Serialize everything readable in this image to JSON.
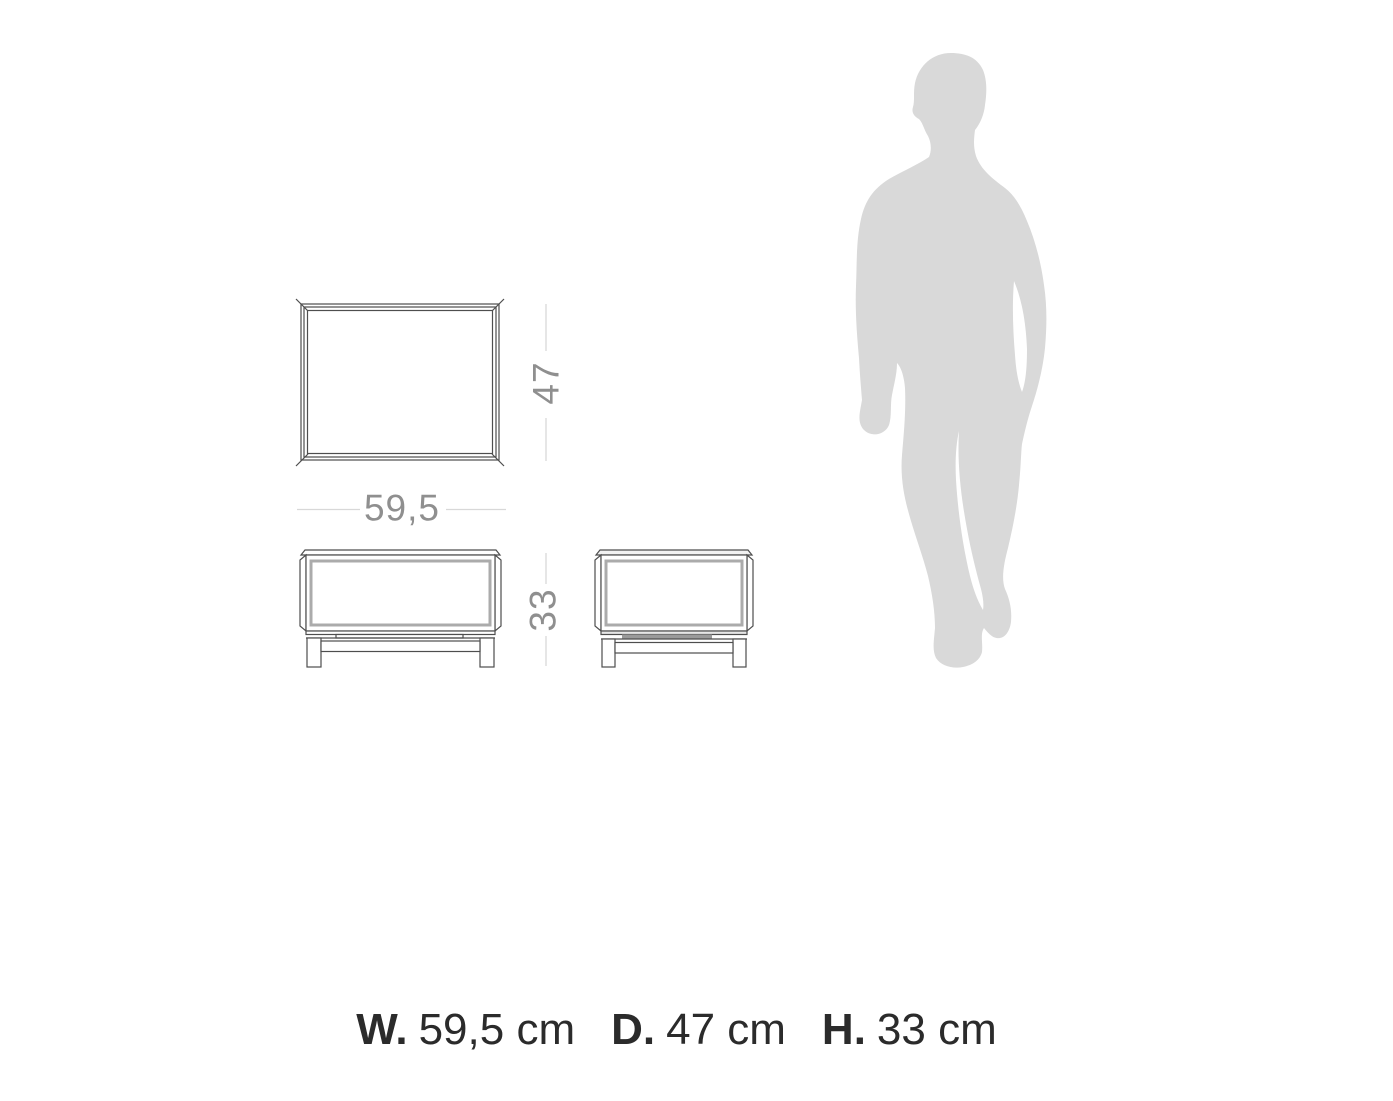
{
  "diagram": {
    "type": "furniture-dimension-drawing",
    "views": {
      "top_view": "top view of table with mitered frame corners",
      "front_view": "front elevation with legs and stretcher",
      "side_view": "side elevation with legs and shaded shelf bar"
    },
    "scale_figure": "human-silhouette"
  },
  "dimensions": {
    "width_label": "59,5",
    "depth_label": "47",
    "height_label": "33"
  },
  "caption": {
    "width_prefix": "W.",
    "width_value": "59,5 cm",
    "depth_prefix": "D.",
    "depth_value": "47 cm",
    "height_prefix": "H.",
    "height_value": "33 cm"
  },
  "colors": {
    "background": "#ffffff",
    "outline": "#4e4e4e",
    "inner_frame": "#ababab",
    "dimension_line": "#d8d8d8",
    "dimension_text": "#8f8f8f",
    "caption_text": "#2b2b2b",
    "silhouette": "#d9d9d9",
    "shaded_bar": "#9a9a9a",
    "light_shade": "#e6e6e6"
  }
}
